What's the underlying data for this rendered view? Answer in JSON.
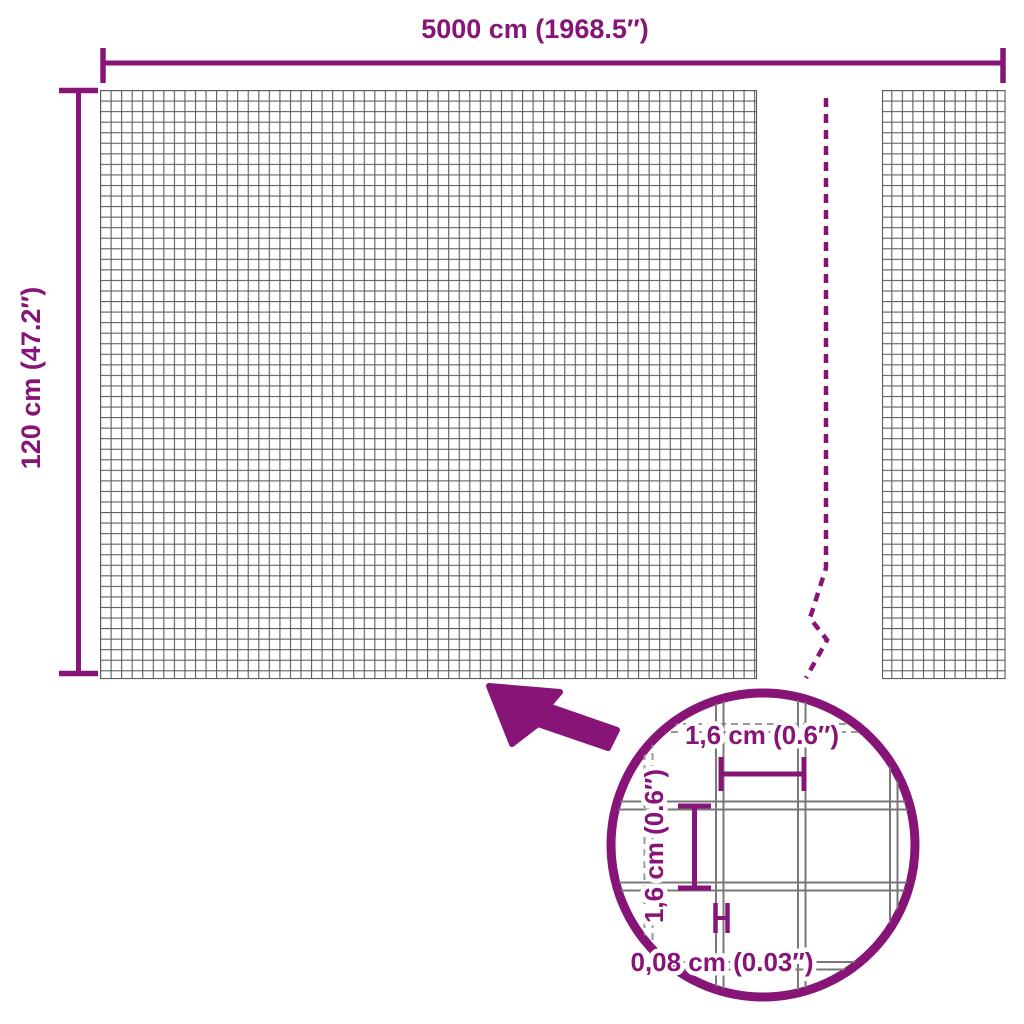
{
  "diagram": {
    "top_dimension_label": "5000 cm (1968.5″)",
    "side_dimension_label": "120 cm (47.2″)",
    "lens": {
      "mesh_width_label": "1,6 cm (0.6″)",
      "mesh_height_label": "1,6 cm (0.6″)",
      "wire_thickness_label": "0,08 cm (0.03″)"
    },
    "colors": {
      "accent": "#871577",
      "grid_line": "#5c5c5c",
      "wire_solid": "#787878",
      "wire_dashed": "#9a9a9a"
    }
  }
}
